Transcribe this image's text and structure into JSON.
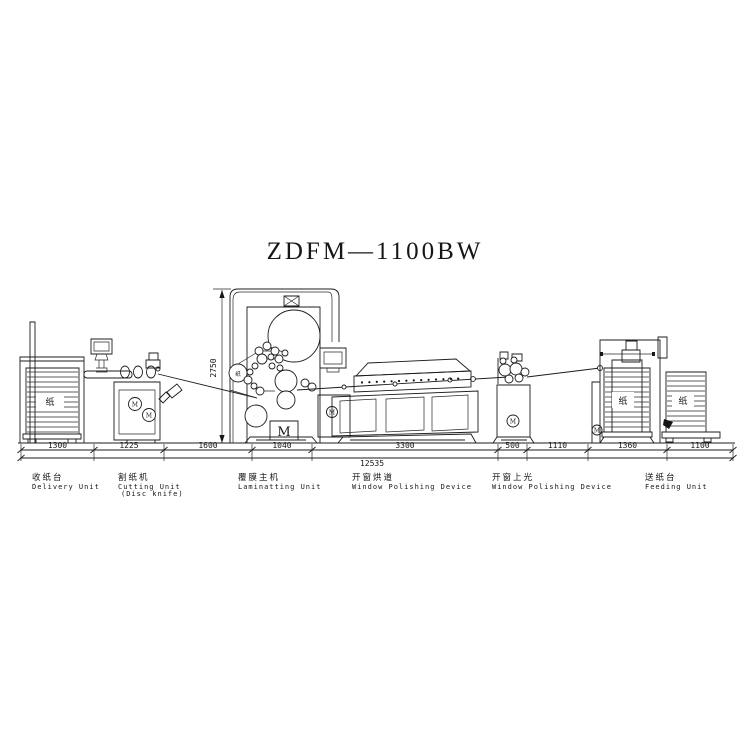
{
  "title": "ZDFM—1100BW",
  "dimensions": {
    "height_mm": "2750",
    "total_mm": "12535",
    "segments_mm": [
      "1300",
      "1225",
      "1600",
      "1040",
      "3300",
      "500",
      "1110",
      "1360",
      "1100"
    ]
  },
  "units": [
    {
      "zh": "收纸台",
      "en": "Delivery Unit",
      "en2": ""
    },
    {
      "zh": "割纸机",
      "en": "Cutting Unit",
      "en2": "(Disc knife)"
    },
    {
      "zh": "覆膜主机",
      "en": "Laminatting Unit",
      "en2": ""
    },
    {
      "zh": "开窗烘道",
      "en": "Window Polishing Device",
      "en2": ""
    },
    {
      "zh": "开窗上光",
      "en": "Window Polishing Device",
      "en2": ""
    },
    {
      "zh": "送纸台",
      "en": "Feeding Unit",
      "en2": ""
    }
  ],
  "glyphs": {
    "paper": "纸",
    "motor": "M"
  },
  "colors": {
    "line": "#1c1c1c",
    "background": "#ffffff"
  }
}
